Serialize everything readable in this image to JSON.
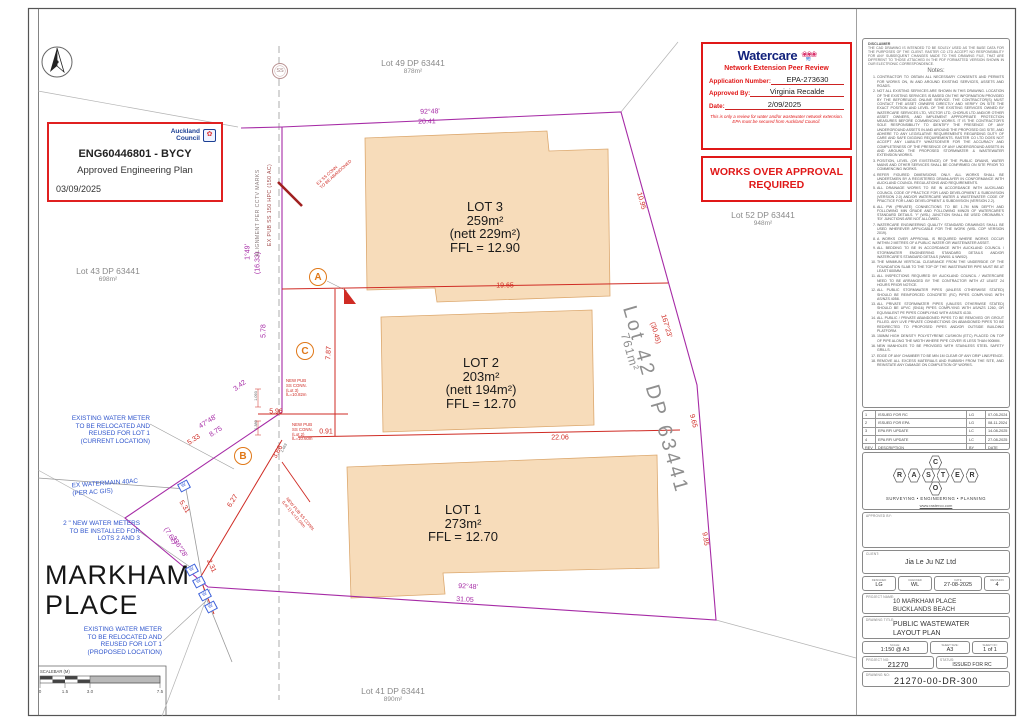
{
  "stamps": {
    "council": {
      "org_lines": [
        "Auckland",
        "Council"
      ],
      "emblem_glyph": "✿",
      "ref": "ENG60446801 - BYCY",
      "subtitle": "Approved Engineering Plan",
      "date": "03/09/2025"
    },
    "watercare": {
      "brand": "Watercare",
      "flower_glyph": "❀❀❀",
      "wave_glyph": "≋",
      "heading": "Network Extension Peer Review",
      "app_label": "Application Number:",
      "app_value": "EPA-273630",
      "approved_label": "Approved By:",
      "approved_value": "Virginia Recalde",
      "date_label": "Date:",
      "date_value": "2/09/2025",
      "note": "This is only a review for water and/or wastewater network extension. EPA must be secured from Auckland Council."
    },
    "works_over_lines": [
      "WORKS OVER APPROVAL",
      "REQUIRED"
    ]
  },
  "plan": {
    "road_lines": [
      "MARKHAM",
      "PLACE"
    ],
    "ss_label": "SS",
    "meter_glyph": "W",
    "parcel_labels": [
      {
        "name": "Lot 49 DP 63441",
        "area": "878m²",
        "x": 413,
        "y": 58
      },
      {
        "name": "Lot 52 DP 63441",
        "area": "948m²",
        "x": 763,
        "y": 210
      },
      {
        "name": "Lot 43 DP 63441",
        "area": "698m²",
        "x": 108,
        "y": 266
      },
      {
        "name": "Lot 41 DP 63441",
        "area": "890m²",
        "x": 393,
        "y": 686
      },
      {
        "name": "Lot 42 DP 63441",
        "area": "761m²",
        "big": true,
        "x": 655,
        "y": 400,
        "rot": 74,
        "ax": 630,
        "ay": 352
      }
    ],
    "lot_blocks": [
      {
        "lines": [
          "LOT 3",
          "259m²",
          "(nett 229m²)",
          "FFL = 12.90"
        ],
        "x": 485,
        "y": 200
      },
      {
        "lines": [
          "LOT 2",
          "203m²",
          "(nett 194m²)",
          "FFL = 12.70"
        ],
        "x": 481,
        "y": 356
      },
      {
        "lines": [
          "LOT 1",
          "273m²",
          "FFL = 12.70"
        ],
        "x": 463,
        "y": 503
      }
    ],
    "dim_labels": [
      {
        "t": "92°48'",
        "x": 430,
        "y": 112,
        "r": -2,
        "c": "m"
      },
      {
        "t": "20.41",
        "x": 427,
        "y": 122,
        "r": -2,
        "c": "m"
      },
      {
        "t": "92°48'",
        "x": 468,
        "y": 587,
        "r": 3,
        "c": "m"
      },
      {
        "t": "31.05",
        "x": 465,
        "y": 600,
        "r": 3,
        "c": "m"
      },
      {
        "t": "1°49'",
        "x": 248,
        "y": 252,
        "r": -90,
        "c": "m"
      },
      {
        "t": "(16.33)",
        "x": 258,
        "y": 263,
        "r": -90,
        "c": "m"
      },
      {
        "t": "5.78",
        "x": 264,
        "y": 331,
        "r": -90,
        "c": "m"
      },
      {
        "t": "3.42",
        "x": 240,
        "y": 386,
        "r": -37,
        "c": "m"
      },
      {
        "t": "47°48'",
        "x": 208,
        "y": 422,
        "r": -33,
        "c": "m"
      },
      {
        "t": "8.75",
        "x": 216,
        "y": 432,
        "r": -33,
        "c": "m"
      },
      {
        "t": "(7.62)",
        "x": 170,
        "y": 536,
        "r": 58,
        "c": "m"
      },
      {
        "t": "336°28'",
        "x": 179,
        "y": 547,
        "r": 58,
        "c": "m"
      },
      {
        "t": "19.65",
        "x": 505,
        "y": 286,
        "c": "r"
      },
      {
        "t": "22.06",
        "x": 560,
        "y": 438,
        "c": "r"
      },
      {
        "t": "5.96",
        "x": 276,
        "y": 412,
        "c": "r"
      },
      {
        "t": "0.91",
        "x": 326,
        "y": 432,
        "c": "r"
      },
      {
        "t": "7.87",
        "x": 329,
        "y": 353,
        "r": -87,
        "c": "r"
      },
      {
        "t": "10.95",
        "x": 641,
        "y": 201,
        "r": 74,
        "c": "r"
      },
      {
        "t": "167°23'",
        "x": 666,
        "y": 326,
        "r": 74,
        "c": "r"
      },
      {
        "t": "(30.45)",
        "x": 655,
        "y": 333,
        "r": 74,
        "c": "r"
      },
      {
        "t": "9.65",
        "x": 693,
        "y": 421,
        "r": 76,
        "c": "r"
      },
      {
        "t": "9.85",
        "x": 705,
        "y": 539,
        "r": 80,
        "c": "r"
      },
      {
        "t": "5.33",
        "x": 194,
        "y": 440,
        "r": -33,
        "c": "r"
      },
      {
        "t": "5.31",
        "x": 184,
        "y": 507,
        "r": 58,
        "c": "r"
      },
      {
        "t": "2.31",
        "x": 211,
        "y": 566,
        "r": 66,
        "c": "r"
      },
      {
        "t": "6.27",
        "x": 233,
        "y": 501,
        "r": -58,
        "c": "r"
      },
      {
        "t": "3.66",
        "x": 278,
        "y": 452,
        "r": -62,
        "c": "r"
      },
      {
        "t": "1.093",
        "x": 256,
        "y": 396,
        "r": -90,
        "c": "k"
      },
      {
        "t": "1.380",
        "x": 256,
        "y": 425,
        "r": -90,
        "c": "k"
      },
      {
        "t": "1.463",
        "x": 284,
        "y": 448,
        "r": -62,
        "c": "k"
      }
    ],
    "callouts": [
      {
        "lines": [
          "NEW PUB",
          "SS CONN.",
          "(Lot 3)",
          "IL=10.82m"
        ],
        "x": 286,
        "y": 379
      },
      {
        "lines": [
          "NEW PUB",
          "SS CONN.",
          "(Lot 2)",
          "IL=10.60m"
        ],
        "x": 292,
        "y": 423
      },
      {
        "lines": [
          "NEW PUB SS CONN.",
          "(Lot 1) IL=11.04m"
        ],
        "x": 288,
        "y": 497,
        "r": 50
      },
      {
        "lines": [
          "EX SS CONN",
          "TO BE ABANDONED"
        ],
        "x": 316,
        "y": 183,
        "r": -42
      }
    ],
    "rotated_notes": [
      {
        "text": "ALIGNMENT PER CCTV MARKS",
        "x": 258,
        "y": 213,
        "r": -90,
        "color": "#8a7d7d"
      },
      {
        "text": "EX PUB SS 150 HPC (150 AC)",
        "x": 270,
        "y": 205,
        "r": -90,
        "color": "#a04848"
      }
    ],
    "blue_notes": [
      {
        "lines": [
          "EXISTING WATER METER",
          "TO BE RELOCATED AND",
          "REUSED FOR LOT 1",
          "(CURRENT LOCATION)"
        ],
        "x": 150,
        "y": 415,
        "align": "right"
      },
      {
        "lines": [
          "EX WATERMAIN 40AC",
          "(PER AC GIS)"
        ],
        "x": 72,
        "y": 480,
        "align": "left",
        "r": -4
      },
      {
        "lines": [
          "2 \" NEW WATER METERS",
          "TO BE INSTALLED FOR",
          "LOTS 2 AND 3"
        ],
        "x": 140,
        "y": 520,
        "align": "right"
      },
      {
        "lines": [
          "EXISTING WATER METER",
          "TO BE RELOCATED AND",
          "REUSED FOR LOT 1",
          "(PROPOSED LOCATION)"
        ],
        "x": 162,
        "y": 626,
        "align": "right"
      }
    ],
    "markers": [
      {
        "label": "A",
        "x": 318,
        "y": 277
      },
      {
        "label": "B",
        "x": 243,
        "y": 456
      },
      {
        "label": "C",
        "x": 305,
        "y": 351
      }
    ],
    "meters": [
      {
        "x": 184,
        "y": 486
      },
      {
        "x": 192,
        "y": 570
      },
      {
        "x": 199,
        "y": 582
      },
      {
        "x": 205,
        "y": 595
      },
      {
        "x": 211,
        "y": 607
      }
    ],
    "scalebar": {
      "label": "SCALEBAR (M)",
      "ticks": [
        {
          "t": "0",
          "x": 40
        },
        {
          "t": "1.5",
          "x": 65
        },
        {
          "t": "3.0",
          "x": 90
        },
        {
          "t": "7.5",
          "x": 160
        }
      ]
    }
  },
  "panel": {
    "disclaimer_title": "DISCLAIMER",
    "disclaimer": "THE CAD DRAWING IS INTENDED TO BE SOLELY USED AS THE BASE DATA FOR THE PURPOSES OF THE CLIENT. RASTER CO LTD ACCEPT NO RESPONSIBILITY FOR ANY SUBSEQUENT CHANGES MADE TO THIS DRAWING FILE, THAT ARE DIFFERENT TO THOSE ATTACHED IN THE PDF FORMATTED VERSION SHOWN IN OUR ELECTRONIC CORRESPONDENCE.",
    "notes_title": "Notes:",
    "notes": [
      "CONTRACTOR TO OBTAIN ALL NECESSARY CONSENTS AND PERMITS FOR WORKS ON, IN AND AROUND EXISTING SERVICES, ASSETS AND ROADS.",
      "NOT ALL EXISTING SERVICES ARE SHOWN IN THIS DRAWING. LOCATION OF THE EXISTING SERVICES IS BASED ON THE INFORMATION PROVIDED BY THE BEFOREUDIG ONLINE SERVICE. THE CONTRACTOR(S) MUST CONTACT THE ASSET OWNERS DIRECTLY AND VERIFY ON SITE THE EXACT POSITION AND LEVEL OF THE EXISTING SERVICES OWNED BY WATERCARE SERVICES LTD, VECTOR LTD, CHORUS LTD AND/OR OTHER ASSET OWNERS, AND IMPLEMENT APPROPRIATE PROTECTION MEASURES BEFORE COMMENCING WORKS. IT IS THE CONTRACTOR'S SOLE RESPONSIBILITY TO IDENTIFY THE PRESENCE OF ANY UNDERGROUND ASSETS IN AND AROUND THE PROPOSED DIG SITE, AND ADHERE TO ANY LEGISLATIVE REQUIREMENTS REGARDING DUTY OF CARE AND SAFE DIGGING REQUIREMENTS. RASTER CO LTD DOES NOT ACCEPT ANY LIABILITY WHATSOEVER FOR THE ACCURACY AND COMPLETENESS OF THE PRESENCE OF ANY UNDERGROUND ASSETS IN AND AROUND THE PROPOSED STORMWATER & WASTEWATER EXTENSION WORKS.",
      "POSITION, LEVEL (OR EXISTENCE) OF THE PUBLIC DRAINS, WATER MAINS AND OTHER SERVICES SHALL BE CONFIRMED ON SITE PRIOR TO COMMENCING WORKS.",
      "REFER FIGURED DIMENSIONS ONLY. ALL WORKS SHALL BE UNDERTAKEN BY A REGISTERED DRAINLAYER IN CONFORMANCE WITH AUCKLAND COUNCIL REGULATIONS AND REQUIREMENTS.",
      "ALL DRAINAGE WORKS TO BE IN ACCORDANCE WITH AUCKLAND COUNCIL CODE OF PRACTICE FOR LAND DEVELOPMENT & SUBDIVISION (VERSION 2.0) AND/OR WATERCARE WATER & WASTEWATER CODE OF PRACTICE FOR LAND DEVELOPMENT & SUBDIVISION (VERSION 2.2).",
      "ALL PW (PRIVATE) CONNECTIONS TO BE 1.7M MIN DEPTH AND FOLLOWING MIN GRADE AND FOLLOWING MIN/25 OF WATERCARE'S STANDARD DETAILS. 'Y' (WSL) JUNCTION SHALL BE USED ORDINARILY. 'EX' JUNCTIONS ARE NOT ALLOWED.",
      "WATERCARE ENGINEERING QUALITY STANDARD DRAWINGS SHALL BE USED WHEREVER APPLICABLE FOR THE WORK (WSL COP VERSION 2019).",
      "A WORKS OVER APPROVAL IS REQUIRED WHERE WORKS OCCUR WITHIN 2 METRES OF A PUBLIC WATER OR WASTEWATER ASSET.",
      "ALL BEDDING TO BE IN ACCORDANCE WITH AUCKLAND COUNCIL / STORMWATER ENGINEERING STANDARD DETAILS AND/OR WATERCARE'S STANDARD DETAILS (WW01 & WW02).",
      "THE MINIMUM VERTICAL CLEARANCE FROM THE UNDERSIDE OF THE FOUNDATION SLAB TO THE TOP OF THE WASTEWATER PIPE MUST BE AT LEAST 600MM.",
      "ALL INSPECTIONS REQUIRED BY AUCKLAND COUNCIL / WATERCARE NEED TO BE ARRANGED BY THE CONTRACTOR WITH AT LEAST 24 HOURS PRIOR NOTICE.",
      "ALL PUBLIC STORMWATER PIPES (UNLESS OTHERWISE STATED) SHOULD BE REINFORCED CONCRETE (RC) PIPES COMPLYING WITH AS/NZS 4058.",
      "ALL PRIVATE STORMWATER PIPES (UNLESS OTHERWISE STATED) SHOULD BE UPVC (SN16) PIPES COMPLYING WITH AS/NZS 1260, OR EQUIVALENT PE PIPES COMPLYING WITH AS/NZS 4130.",
      "ALL PUBLIC / PRIVATE ABANDONED PIPES TO BE REMOVED OR GROUT FILLED. ANY LIVE PRIVATE CONNECTIONS ON ABANDONED PIPES TO BE REDIRECTED TO PROPOSED PIPES AND/OR OUTSIDE BUILDING PLATFORM.",
      "150MM HIGH DENSITY POLYSTYRENE CUSHION (ETC) PLACED ON TOP OF PIPE ALONG THE WIDTH WHERE PIPE COVER IS LESS THAN 900MM.",
      "NEW MANHOLES TO BE PROVIDED WITH STAINLESS STEEL SAFETY GRILLS.",
      "EDGE OF ANY CHAMBER TO BE MIN 1M CLEAR OF ANY DRIP LINE/FENCE.",
      "REMOVE ALL EXCESS MATERIALS AND RUBBISH FROM THE SITE, AND REINSTATE ANY DAMAGE ON COMPLETION OF WORKS."
    ],
    "revisions": {
      "headers": [
        "REV",
        "DESCRIPTION",
        "BY",
        "DATE"
      ],
      "rows": [
        [
          "1",
          "ISSUED FOR RC",
          "LG",
          "07-05-2024"
        ],
        [
          "2",
          "ISSUED FOR EPA",
          "LG",
          "08-11-2024"
        ],
        [
          "3",
          "EPA RFI UPDATE",
          "LC",
          "14-08-2025"
        ],
        [
          "4",
          "EPA RFI UPDATE",
          "LC",
          "27-08-2025"
        ]
      ]
    },
    "logo": {
      "letters": [
        "R",
        "A",
        "S",
        "T",
        "E",
        "R"
      ],
      "top": "C",
      "bottom": "O",
      "tagline": "SURVEYING   •   ENGINEERING   •   PLANNING",
      "website": "www.rasterco.com"
    },
    "approved_by_label": "APPROVED BY:",
    "client_label": "CLIENT:",
    "client": "Jia Le Ju NZ Ltd",
    "meta": [
      {
        "label": "DESIGNED",
        "value": "LG",
        "w": 34
      },
      {
        "label": "CHECKED",
        "value": "WL",
        "w": 34
      },
      {
        "label": "DATE",
        "value": "27-08-2025",
        "w": 48
      },
      {
        "label": "REVISION",
        "value": "4",
        "w": 26
      }
    ],
    "project_label": "PROJECT NAME:",
    "project_lines": [
      "10 MARKHAM PLACE",
      "BUCKLANDS BEACH"
    ],
    "title_label": "DRAWING TITLE:",
    "title_lines": [
      "PUBLIC WASTEWATER",
      "LAYOUT PLAN"
    ],
    "scale_label": "SCALE:",
    "scale_value": "1:150 @ A3",
    "sheet_size_label": "SHEET SIZE:",
    "sheet_size_value": "A3",
    "sheet_no_label": "SHEET NO:",
    "sheet_no_value": "1 of 1",
    "project_no_label": "PROJECT NO:",
    "project_no_value": "21270",
    "status_label": "STATUS:",
    "status_value": "ISSUED FOR RC",
    "drawing_no_label": "DRAWING NO:",
    "drawing_no_value": "21270-00-DR-300"
  },
  "colors": {
    "boundary": "#a62ba6",
    "proposed": "#cf2b24",
    "building_fill": "#f7dcba",
    "building_stroke": "#dca86e",
    "water_blue": "#2f55cc",
    "stamp_red": "#e01818"
  }
}
